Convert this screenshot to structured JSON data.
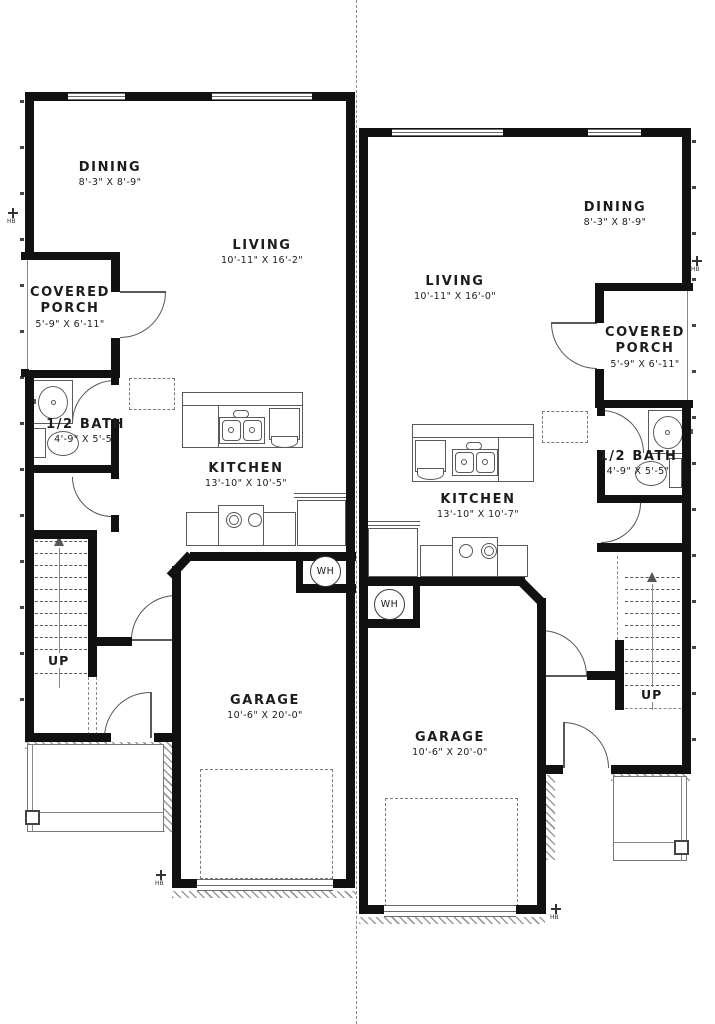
{
  "units": {
    "left": {
      "dining": {
        "name": "DINING",
        "dims": "8'-3\" X 8'-9\""
      },
      "living": {
        "name": "LIVING",
        "dims": "10'-11\" X 16'-2\""
      },
      "porch": {
        "name": "COVERED PORCH",
        "dims": "5'-9\" X 6'-11\""
      },
      "bath": {
        "name": "1/2 BATH",
        "dims": "4'-9\" X 5'-5\""
      },
      "kitchen": {
        "name": "KITCHEN",
        "dims": "13'-10\" X 10'-5\""
      },
      "garage": {
        "name": "GARAGE",
        "dims": "10'-6\" X 20'-0\""
      },
      "stairs": "UP",
      "water_heater": "WH"
    },
    "right": {
      "dining": {
        "name": "DINING",
        "dims": "8'-3\" X 8'-9\""
      },
      "living": {
        "name": "LIVING",
        "dims": "10'-11\" X 16'-0\""
      },
      "porch": {
        "name": "COVERED PORCH",
        "dims": "5'-9\" X 6'-11\""
      },
      "bath": {
        "name": "1/2 BATH",
        "dims": "4'-9\" X 5'-5\""
      },
      "kitchen": {
        "name": "KITCHEN",
        "dims": "13'-10\" X 10'-7\""
      },
      "garage": {
        "name": "GARAGE",
        "dims": "10'-6\" X 20'-0\""
      },
      "stairs": "UP",
      "water_heater": "WH"
    }
  },
  "symbols": {
    "hose_bib": "HB"
  },
  "colors": {
    "walls": "#111111",
    "fixtures": "#555555",
    "background": "#ffffff"
  }
}
